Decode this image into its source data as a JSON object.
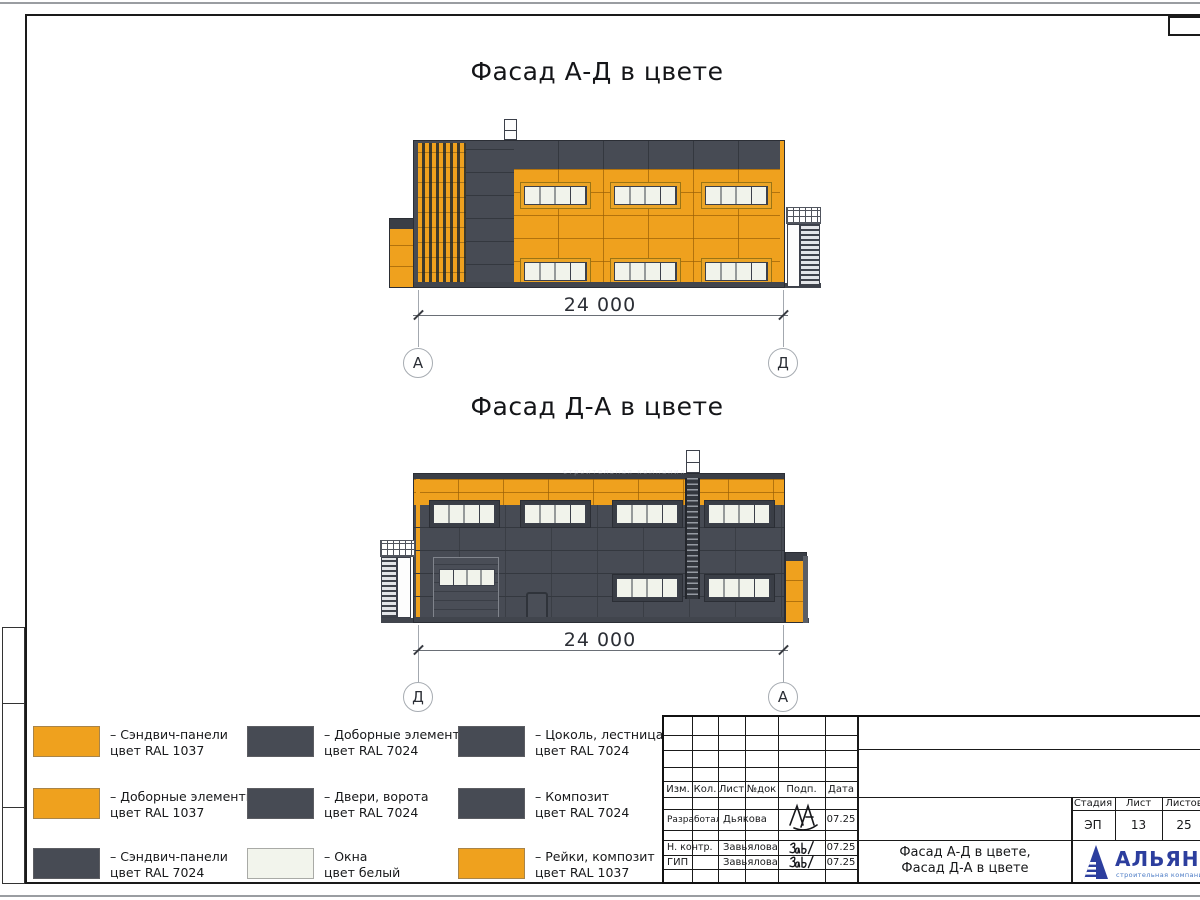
{
  "colors": {
    "orange": "#EFA11E",
    "dark": "#474B54",
    "dark_line": "#34383F",
    "dark_deep": "#3A3E46",
    "outline": "#2B2E35",
    "window_white": "#F1F3EB",
    "window_frame": "#3C404A",
    "plinth": "#41454D",
    "logo_blue": "#2C3E9E",
    "logo_light_blue": "#4A7AC5"
  },
  "facade1": {
    "title": "Фасад А-Д в цвете",
    "dim": "24 000",
    "axis_left": "А",
    "axis_right": "Д"
  },
  "facade2": {
    "title": "Фасад Д-А в цвете",
    "dim": "24 000",
    "axis_left": "Д",
    "axis_right": "А",
    "watermark": "строительная компания"
  },
  "legend": {
    "items": [
      {
        "swatch": "#EFA11E",
        "line1": "– Сэндвич-панели",
        "line2": "цвет RAL 1037"
      },
      {
        "swatch": "#474B54",
        "line1": "– Доборные элементы",
        "line2": "цвет RAL 7024"
      },
      {
        "swatch": "#474B54",
        "line1": "– Цоколь, лестница",
        "line2": "цвет RAL 7024"
      },
      {
        "swatch": "#EFA11E",
        "line1": "– Доборные элементы",
        "line2": "цвет RAL 1037"
      },
      {
        "swatch": "#474B54",
        "line1": "– Двери, ворота",
        "line2": "цвет RAL 7024"
      },
      {
        "swatch": "#474B54",
        "line1": "– Композит",
        "line2": "цвет RAL 7024"
      },
      {
        "swatch": "#474B54",
        "line1": "– Сэндвич-панели",
        "line2": "цвет RAL 7024"
      },
      {
        "swatch": "#F2F4EC",
        "line1": "– Окна",
        "line2": "цвет белый"
      },
      {
        "swatch": "#EFA11E",
        "line1": "– Рейки, композит",
        "line2": "цвет RAL 1037"
      }
    ]
  },
  "titleblock": {
    "change_cols": [
      "Изм.",
      "Кол.",
      "Лист",
      "№док",
      "Подп.",
      "Дата"
    ],
    "sign_rows": [
      {
        "role": "Разработал",
        "name": "Дьякова",
        "date": "07.25"
      },
      {
        "role": "Н. контр.",
        "name": "Завьялова",
        "date": "07.25"
      },
      {
        "role": "ГИП",
        "name": "Завьялова",
        "date": "07.25"
      }
    ],
    "doc_name_1": "Фасад А-Д в цвете,",
    "doc_name_2": "Фасад Д-А в цвете",
    "stage_label": "Стадия",
    "sheet_label": "Лист",
    "sheets_label": "Листов",
    "stage_value": "ЭП",
    "sheet_value": "13",
    "sheets_value": "25",
    "company_name": "АЛЬЯНС",
    "company_tagline": "строительная компания"
  }
}
